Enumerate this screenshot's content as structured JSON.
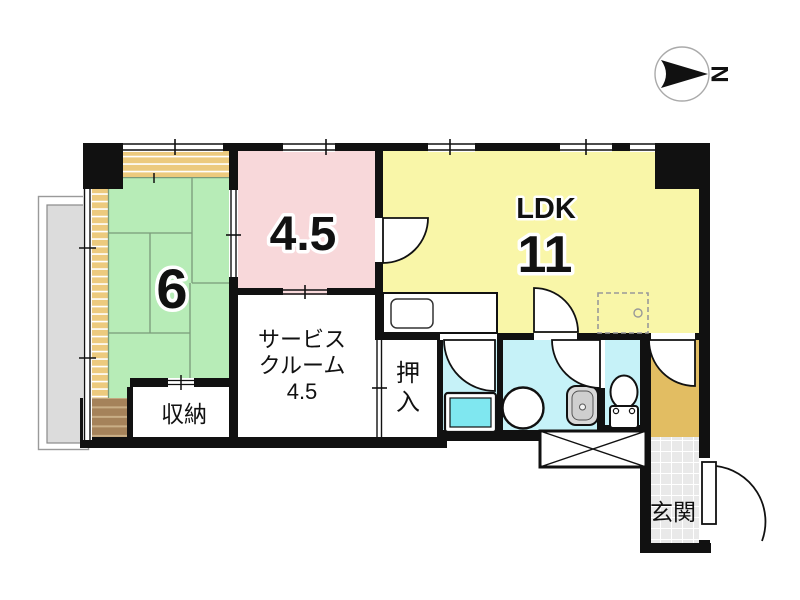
{
  "compass": {
    "label": "N"
  },
  "rooms": {
    "tatami": {
      "label": "6"
    },
    "pink_room": {
      "label": "4.5"
    },
    "ldk": {
      "label": "LDK",
      "size": "11"
    },
    "service_room": {
      "line1": "サービス",
      "line2": "クルーム",
      "line3": "4.5"
    },
    "oshiire": {
      "char1": "押",
      "char2": "入"
    },
    "storage": {
      "label": "収納"
    },
    "genkan": {
      "label": "玄関"
    }
  },
  "colors": {
    "wall": "#111111",
    "tatami_green": "#b7ecb7",
    "pink": "#f8d8da",
    "ldk_yellow": "#f9f6a8",
    "bath_cyan": "#c6f2f8",
    "pan_cyan": "#7fe7f0",
    "corridor_tan": "#e2bd62",
    "engawa_tan": "#ecca7e",
    "step_brown": "#a5825a",
    "balcony_gray": "#dcdcdc",
    "tile_gray": "#e9e9e9",
    "room_white": "#ffffff"
  }
}
